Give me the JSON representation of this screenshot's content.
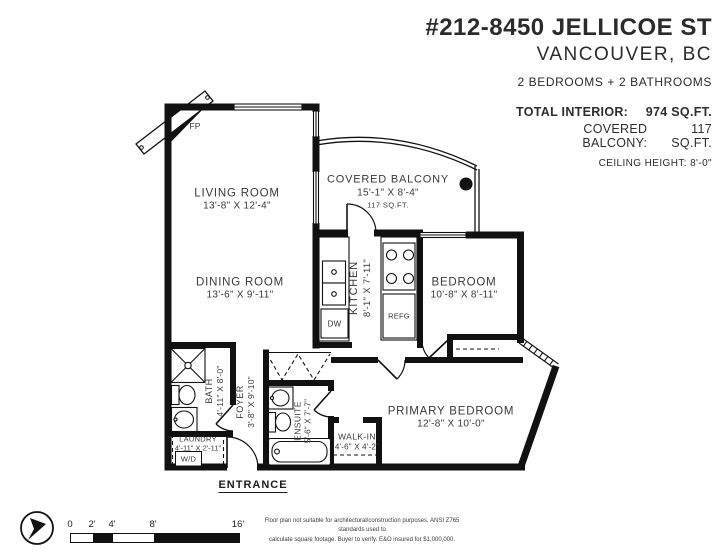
{
  "header": {
    "title": "#212-8450 JELLICOE ST",
    "subtitle": "VANCOUVER, BC",
    "beds_baths": "2 BEDROOMS + 2 BATHROOMS",
    "stats": [
      {
        "label": "TOTAL INTERIOR:",
        "value": "974 SQ.FT."
      },
      {
        "label": "COVERED BALCONY:",
        "value": "117 SQ.FT."
      }
    ],
    "ceiling": "CEILING HEIGHT: 8'-0\""
  },
  "rooms": {
    "living": {
      "name": "LIVING ROOM",
      "dims": "13'-8\" X 12'-4\""
    },
    "balcony": {
      "name": "COVERED BALCONY",
      "dims": "15'-1\" X 8'-4\"",
      "area": "117 SQ.FT."
    },
    "dining": {
      "name": "DINING ROOM",
      "dims": "13'-6\" X 9'-11\""
    },
    "kitchen": {
      "name": "KITCHEN",
      "dims": "8'-1\" X 7'-11\""
    },
    "bedroom": {
      "name": "BEDROOM",
      "dims": "10'-8\" X 8'-11\""
    },
    "primary": {
      "name": "PRIMARY BEDROOM",
      "dims": "12'-8\" X 10'-0\""
    },
    "walkin": {
      "name": "WALK-IN",
      "dims": "4'-6\" X 4'-2\""
    },
    "ensuite": {
      "name": "ENSUITE",
      "dims": "5'-6\" X 7'-7\""
    },
    "bath": {
      "name": "BATH",
      "dims": "4'-11\" X 8'-0\""
    },
    "laundry": {
      "name": "LAUNDRY",
      "dims": "4'-11\" X 2'-11\"",
      "appliance": "W/D"
    },
    "foyer": {
      "name": "FOYER",
      "dims": "3'-8\" X 9'-10\""
    }
  },
  "fixtures": {
    "fireplace": "FP",
    "dishwasher": "DW",
    "fridge": "REFG"
  },
  "entrance_label": "ENTRANCE",
  "scale_bar": {
    "ticks": [
      "0",
      "2'",
      "4'",
      "8'",
      "16'"
    ]
  },
  "disclaimer": {
    "line1": "Floor plan not suitable for architectural/construction purposes. ANSI Z765 standards used to",
    "line2": "calculate square footage. Buyer to verify. E&O insured for $1,000,000."
  },
  "colors": {
    "line": "#111111",
    "background": "#ffffff"
  }
}
